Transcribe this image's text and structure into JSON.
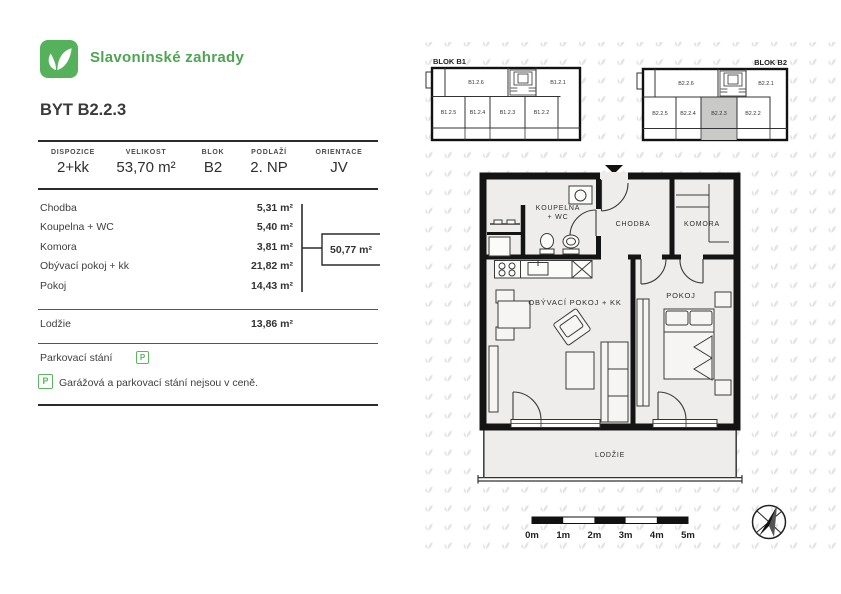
{
  "brand": {
    "name": "Slavonínské zahrady"
  },
  "title": "BYT B2.2.3",
  "summary": {
    "items": [
      {
        "label": "DISPOZICE",
        "value": "2+kk"
      },
      {
        "label": "VELIKOST",
        "value": "53,70 m²"
      },
      {
        "label": "BLOK",
        "value": "B2"
      },
      {
        "label": "PODLAŽÍ",
        "value": "2. NP"
      },
      {
        "label": "ORIENTACE",
        "value": "JV"
      }
    ]
  },
  "rooms": {
    "items": [
      {
        "label": "Chodba",
        "area": "5,31 m²"
      },
      {
        "label": "Koupelna + WC",
        "area": "5,40 m²"
      },
      {
        "label": "Komora",
        "area": "3,81 m²"
      },
      {
        "label": "Obývací pokoj + kk",
        "area": "21,82 m²"
      },
      {
        "label": "Pokoj",
        "area": "14,43 m²"
      }
    ],
    "subtotal": "50,77 m²",
    "loggia_label": "Lodžie",
    "loggia_area": "13,86 m²"
  },
  "parking": {
    "label": "Parkovací stání",
    "badge": "P",
    "note": "Garážová a parkovací stání nejsou v ceně."
  },
  "blocks": {
    "b1": {
      "label": "BLOK B1",
      "top_left": "B1.2.6",
      "top_right": "B1.2.1",
      "bottom": [
        "B1.2.5",
        "B1.2.4",
        "B1.2.3",
        "B1.2.2"
      ]
    },
    "b2": {
      "label": "BLOK B2",
      "top_left": "B2.2.6",
      "top_right": "B2.2.1",
      "bottom": [
        "B2.2.5",
        "B2.2.4",
        "B2.2.3",
        "B2.2.2"
      ],
      "highlighted_unit": "B2.2.3"
    }
  },
  "floorplan": {
    "koupelna_line1": "KOUPELNA",
    "koupelna_line2": "+ WC",
    "chodba": "CHODBA",
    "komora": "KOMORA",
    "obyvaci": "OBÝVACÍ POKOJ + KK",
    "pokoj": "POKOJ",
    "lodzie": "LODŽIE"
  },
  "scalebar": {
    "labels": [
      "0m",
      "1m",
      "2m",
      "3m",
      "4m",
      "5m"
    ]
  },
  "colors": {
    "brand_green": "#4ea553",
    "logo_green": "#55b25a",
    "badge_green": "#5cb660",
    "highlight_gray": "#c9c9c7",
    "plan_floor": "#efedeb",
    "wall_black": "#141414",
    "watermark_gray": "#e3e3e3"
  }
}
